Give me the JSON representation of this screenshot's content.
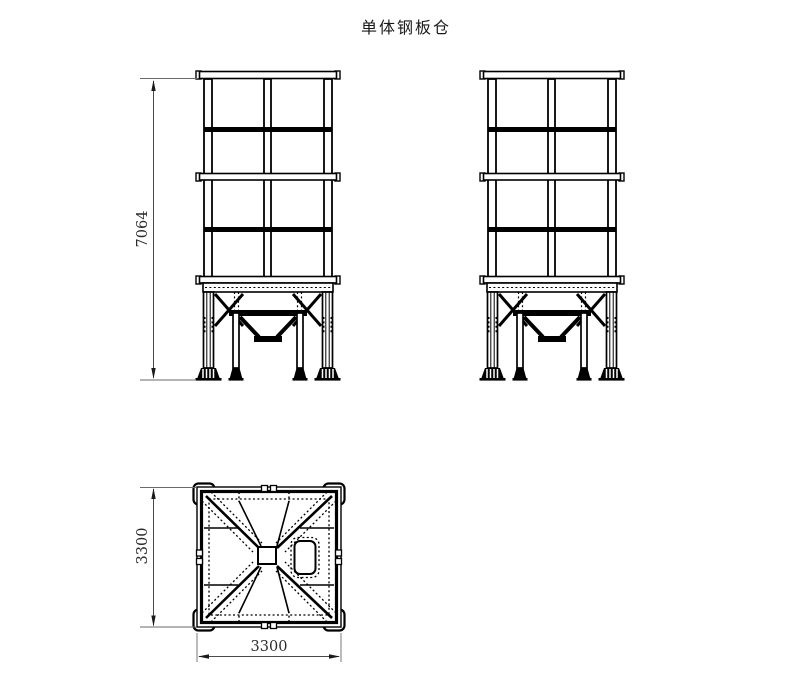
{
  "title": "单体钢板仓",
  "dimensions": {
    "overall_height": "7064",
    "plan_depth": "3300",
    "plan_width": "3300"
  },
  "colors": {
    "background": "#ffffff",
    "line": "#000000",
    "dimension": "#4a4a4a"
  }
}
